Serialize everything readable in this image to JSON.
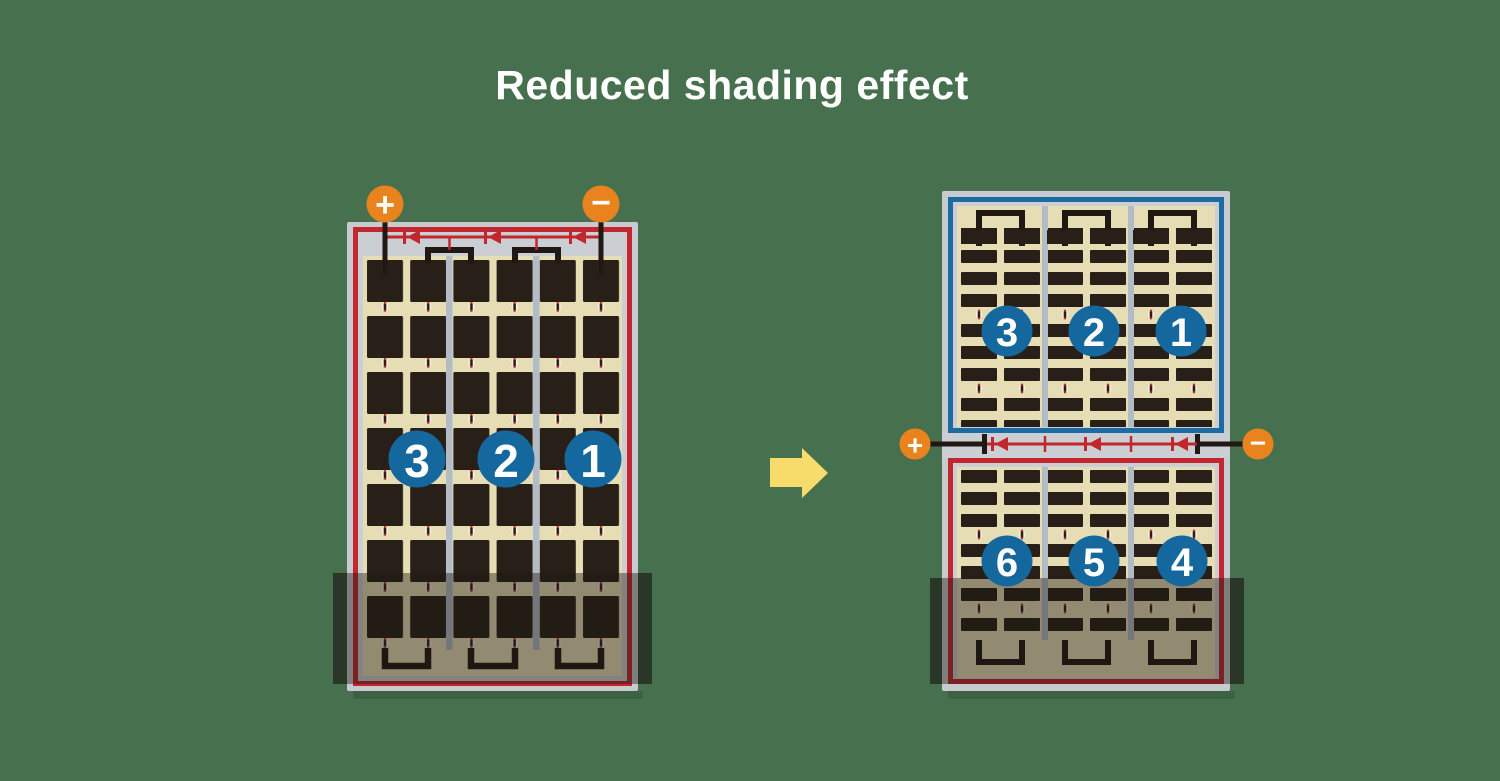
{
  "title": "Reduced shading effect",
  "colors": {
    "background": "#47714E",
    "title_text": "#FFFFFF",
    "frame_gray": "#C7CACE",
    "bus_band_gray": "#CBCFD4",
    "panel_tan": "#E7DDB5",
    "cell_dark": "#281F18",
    "divider_gray": "#B1BCC6",
    "border_red": "#C1272D",
    "border_blue": "#1C6BA3",
    "bus_red": "#C1272D",
    "wire_black": "#201812",
    "terminal_orange": "#E8831D",
    "terminal_text": "#FFFFFF",
    "circle_blue": "#15689D",
    "number_text": "#FFFFFF",
    "arrow_yellow": "#F8DC6B",
    "solder_white": "#F5F1E3",
    "solder_red": "#C1272D",
    "shade_main": "rgba(28,25,20,0.42)",
    "shade_edge": "rgba(28,25,20,0.66)",
    "panel_shadow": "rgba(0,0,0,0.14)"
  },
  "left_panel": {
    "positive_label": "+",
    "negative_label": "−",
    "diode_count": 3,
    "strings": [
      "3",
      "2",
      "1"
    ]
  },
  "right_panel": {
    "positive_label": "+",
    "negative_label": "−",
    "diode_count": 3,
    "top_strings": [
      "3",
      "2",
      "1"
    ],
    "bottom_strings": [
      "6",
      "5",
      "4"
    ]
  }
}
